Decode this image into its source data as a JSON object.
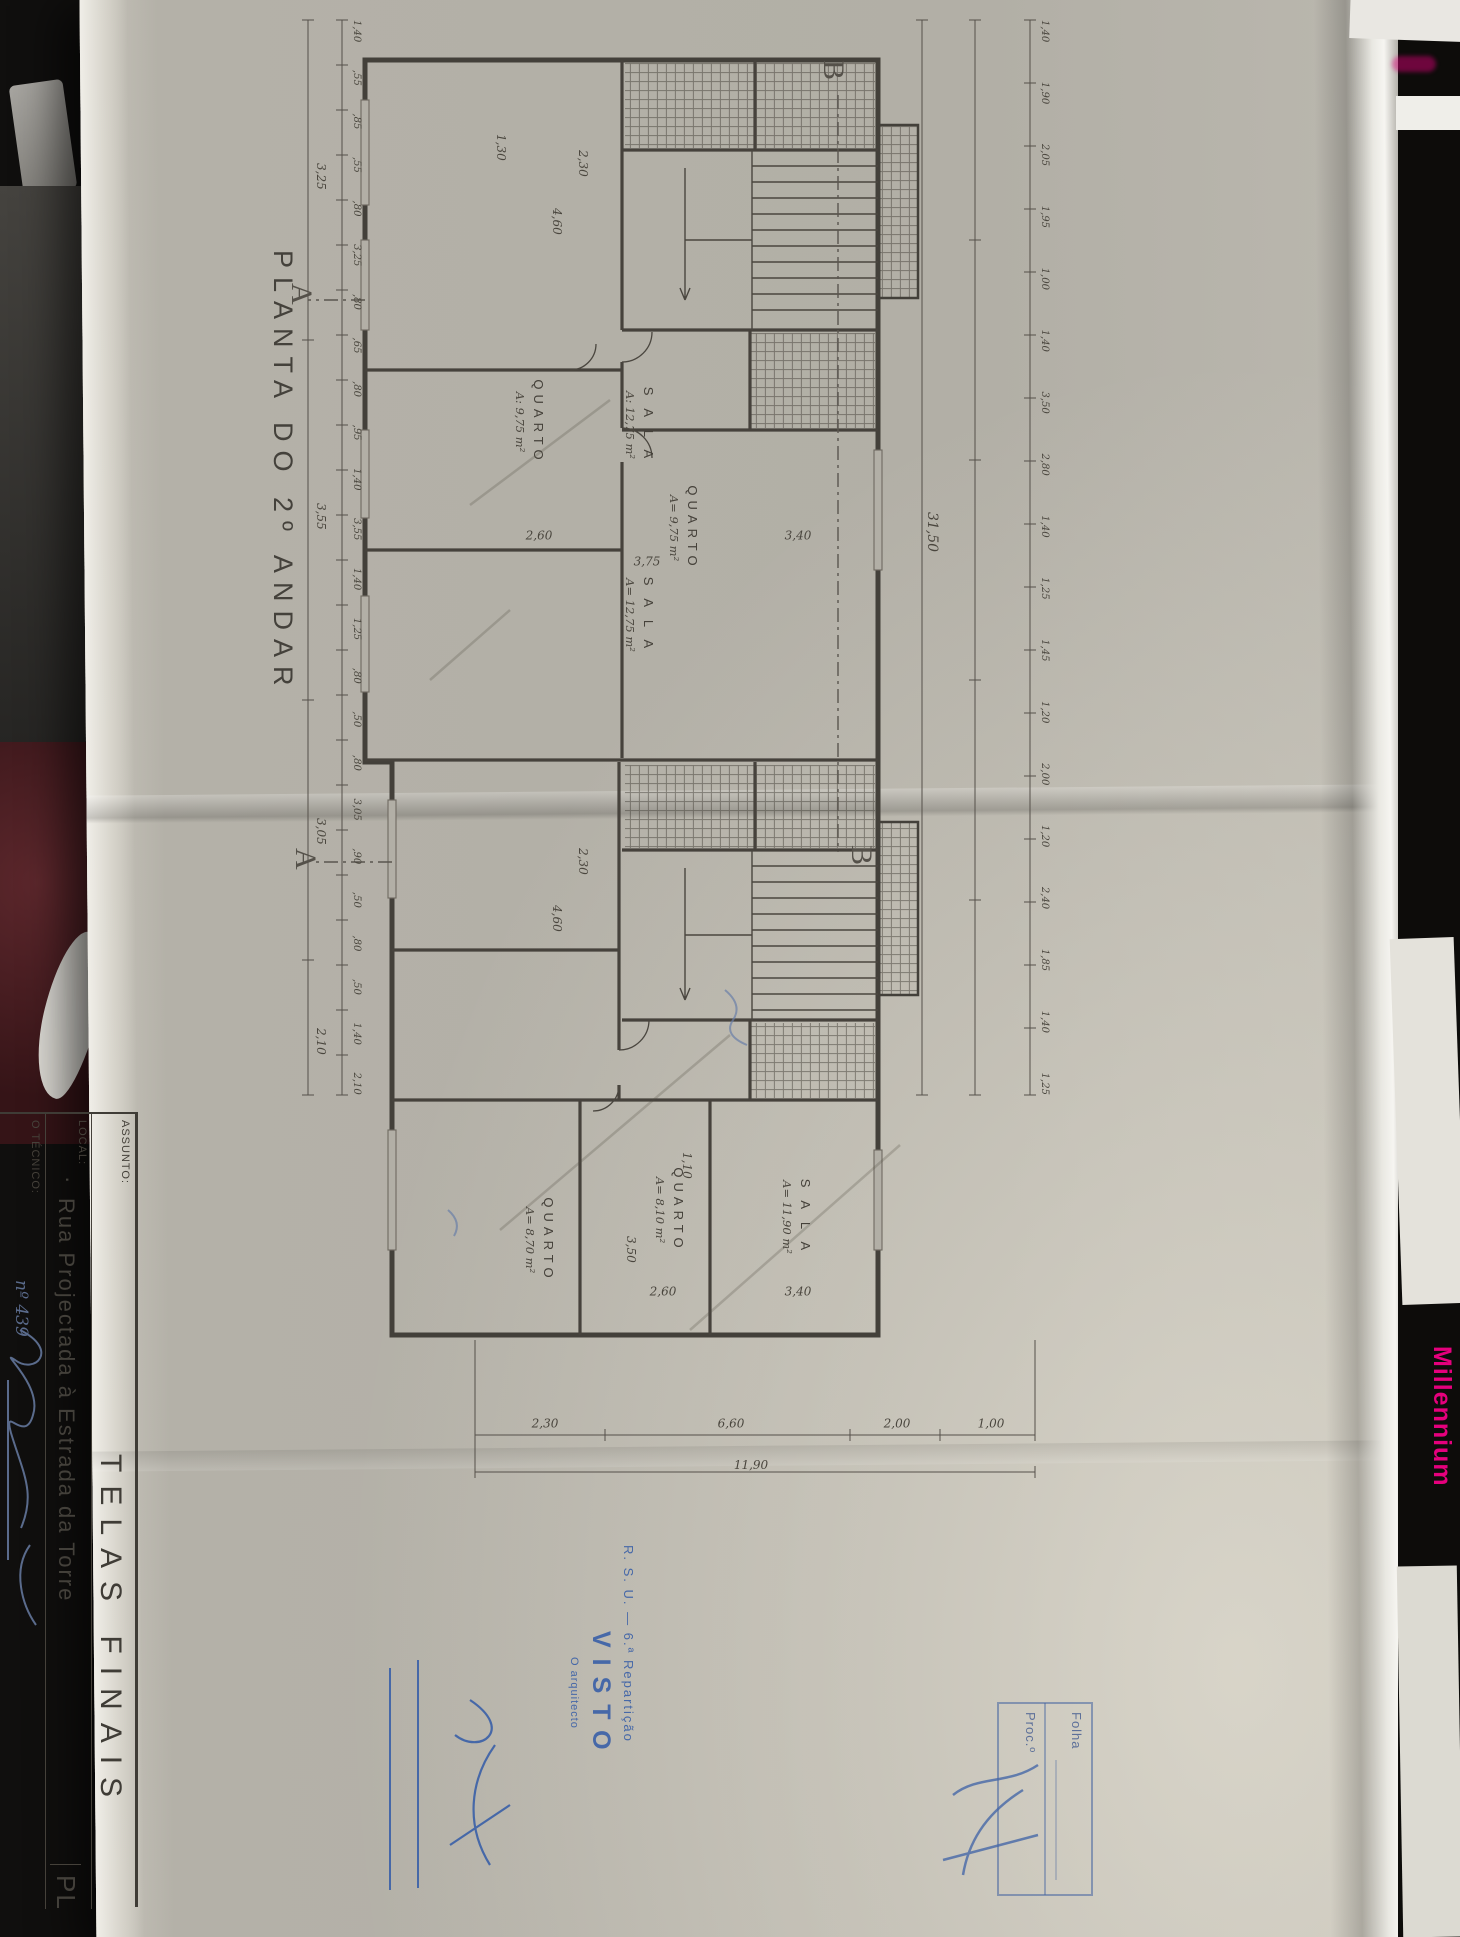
{
  "photo": {
    "brand_text": "Millennium",
    "brand_color": "#e5007d"
  },
  "sheet": {
    "title": "PLANTA DO 2º ANDAR",
    "title_block": {
      "assunto_label": "ASSUNTO:",
      "assunto_value": "TELAS FINAIS",
      "local_label": "LOCAL:",
      "local_bullet": "·",
      "local_value": "Rua Projectada à Estrada da Torre",
      "tecnico_label": "O TÉCNICO:",
      "tecnico_number": "nº 439",
      "corner_text": "PL"
    },
    "stamp": {
      "dept_line": "R. S. U. — 6.ª Repartição",
      "visto": "VISTO",
      "role_line": "O arquitecto"
    },
    "folha_box": {
      "folha_label": "Folha",
      "proc_label": "Proc.º"
    },
    "sections": {
      "a": "A",
      "b": "B"
    },
    "rooms": [
      {
        "name": "S A L A",
        "area": "A: 12,75 m²"
      },
      {
        "name": "QUARTO",
        "area": "A: 9,75 m²"
      },
      {
        "name": "QUARTO",
        "area": "A= 9,75 m²"
      },
      {
        "name": "S A L A",
        "area": "A= 12,75 m²"
      },
      {
        "name": "S A L A",
        "area": "A= 11,90 m²"
      },
      {
        "name": "QUARTO",
        "area": "A= 8,10 m²"
      },
      {
        "name": "QUARTO",
        "area": "A= 8,70 m²"
      }
    ],
    "dims": {
      "top_chain": [
        "1,40",
        "1,90",
        "2,05",
        "1,95",
        "1,00",
        "1,40",
        "3,50",
        "2,80",
        "1,40",
        "1,25",
        "1,45",
        "1,20",
        "2,00",
        "1,20",
        "2,40",
        "1,85",
        "1,40",
        "1,25"
      ],
      "top_total": "31,50",
      "bottom_chain": [
        "1,40",
        ",55",
        ",85",
        ",55",
        ",80",
        "3,25",
        ",80",
        ",65",
        ",80",
        ",95",
        "1,40",
        "3,55",
        "1,40",
        "1,25",
        ",80",
        ",50",
        ",80",
        "3,05",
        ",90",
        ",50",
        ",80",
        ",50",
        "1,40",
        "2,10"
      ],
      "bottom_spans": [
        "3,25",
        "3,55",
        "3,05",
        "2,10"
      ],
      "right_chain": [
        "1,00",
        "2,00",
        "6,60",
        "2,30"
      ],
      "right_total": "11,90",
      "stair1_width": "2,30",
      "stair1_len": "4,60",
      "stair2_width": "2,30",
      "stair2_len": "4,60",
      "room_dims": [
        "3,40",
        "2,60",
        "3,75",
        "3,40",
        "2,60",
        "3,50",
        "1,30",
        "1,10"
      ]
    }
  }
}
